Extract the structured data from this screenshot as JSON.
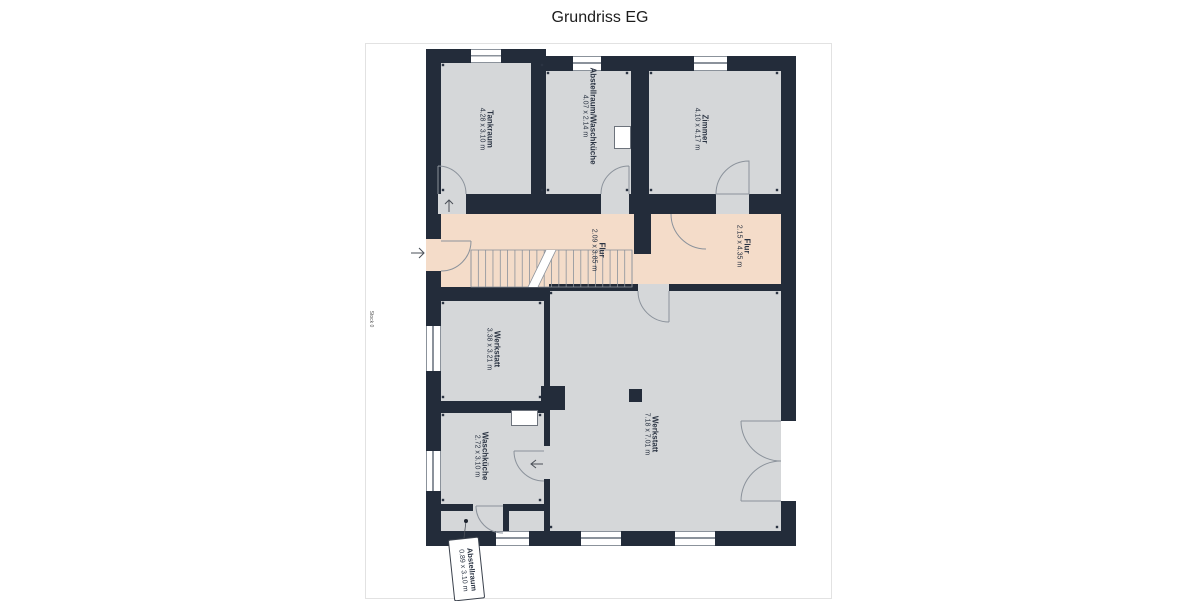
{
  "title": "Grundriss EG",
  "floor_label": "Stock 0",
  "rooms": [
    {
      "name": "Tankraum",
      "dims": "4.28 x 3.10 m"
    },
    {
      "name": "Abstellraum/Waschküche",
      "dims": "4.07 x 2.14 m"
    },
    {
      "name": "Zimmer",
      "dims": "4.10 x 4.17 m"
    },
    {
      "name": "Flur",
      "dims": "2.09 x 3.85 m"
    },
    {
      "name": "Flur",
      "dims": "2.15 x 4.35 m"
    },
    {
      "name": "Werkstatt",
      "dims": "3.38 x 3.21 m"
    },
    {
      "name": "Waschküche",
      "dims": "2.72 x 3.10 m"
    },
    {
      "name": "Werkstatt",
      "dims": "7.18 x 7.01 m"
    },
    {
      "name": "Abstellraum",
      "dims": "0.89 x 3.10 m"
    }
  ],
  "colors": {
    "wall": "#232c3a",
    "room": "#d5d7d9",
    "corridor": "#f4dcc9",
    "line": "#8b929b",
    "text": "#2b3443"
  }
}
